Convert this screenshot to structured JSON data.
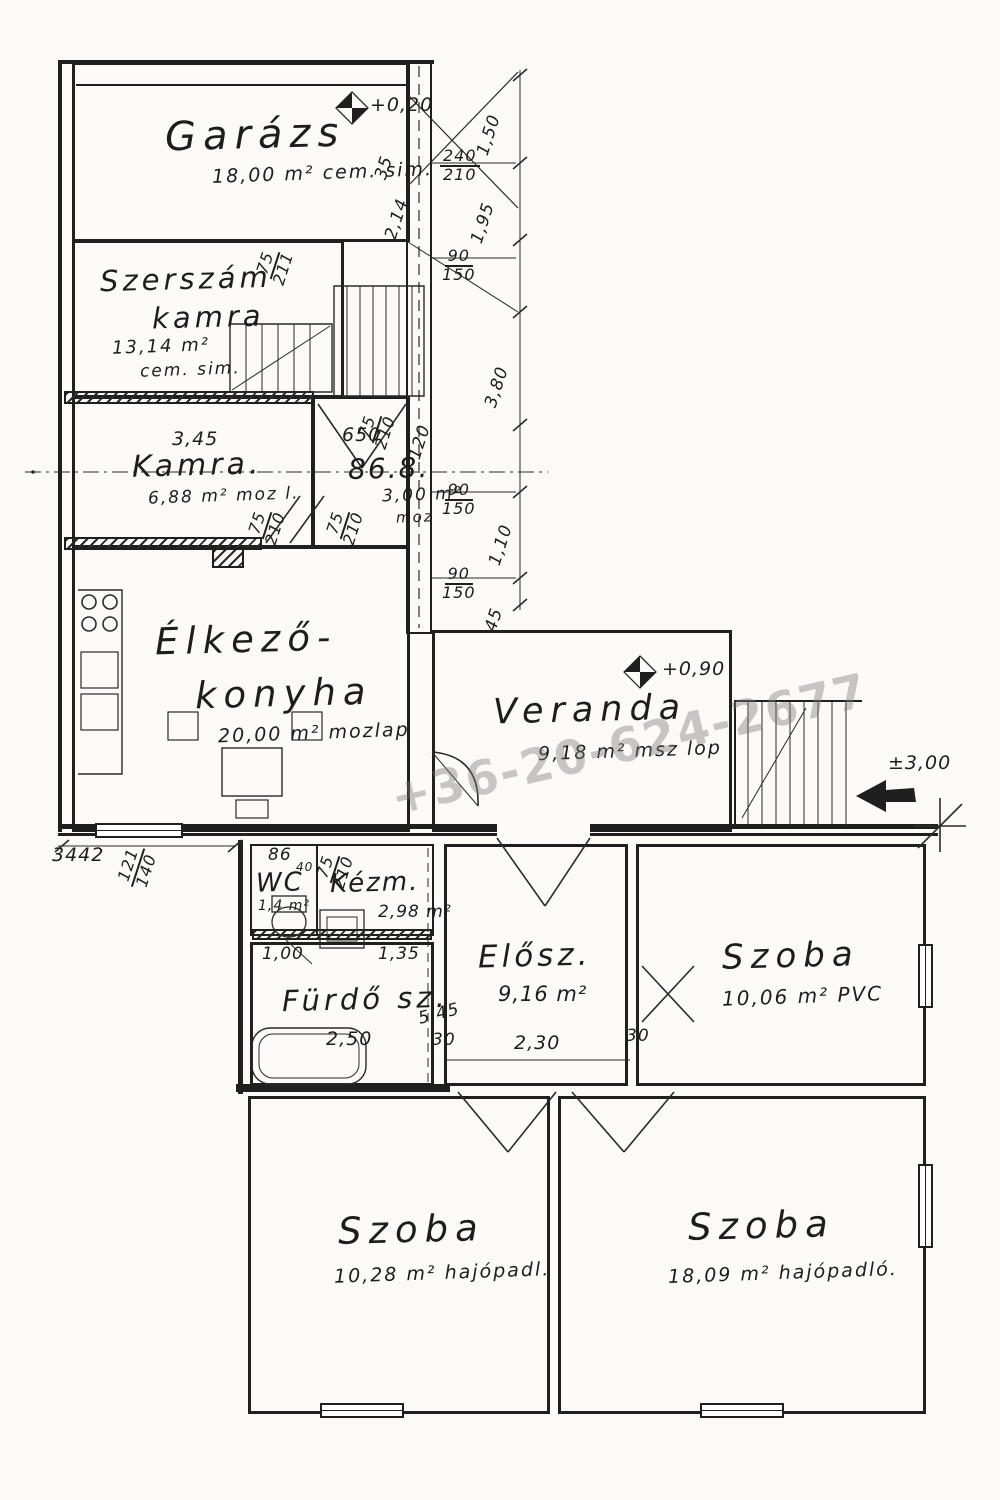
{
  "watermark": {
    "phone": "+36-20-624-2677"
  },
  "levels": {
    "garage": "+0,20",
    "veranda": "+0,90",
    "entry": "±3,00"
  },
  "rooms": [
    {
      "name": "Garázs",
      "area": "18,00 m²",
      "floor": "cem. sim."
    },
    {
      "name1": "Szerszám",
      "name2": "kamra",
      "area": "13,14 m²",
      "floor": "cem. sim."
    },
    {
      "name": "Kamra.",
      "area": "6,88 m²",
      "floor": "moz l."
    },
    {
      "name": "86.8.",
      "area": "3,00 m²",
      "floor": "moz"
    },
    {
      "name1": "Élkező-",
      "name2": "konyha",
      "area": "20,00 m²",
      "floor": "mozlap"
    },
    {
      "name": "Veranda",
      "area": "9,18 m²",
      "floor": "msz lop"
    },
    {
      "name": "WC",
      "area": "1,4 m²",
      "note": "40"
    },
    {
      "name": "Kézm.",
      "area": "2,98 m²"
    },
    {
      "name": "Fürdő sz.",
      "width": "2,50"
    },
    {
      "name": "Elősz.",
      "area": "9,16 m²",
      "width": "2,30"
    },
    {
      "name": "Szoba",
      "area": "10,06 m²",
      "floor": "PVC"
    },
    {
      "name": "Szoba",
      "area": "10,28 m²",
      "floor": "hajópadl."
    },
    {
      "name": "Szoba",
      "area": "18,09 m²",
      "floor": "hajópadló."
    }
  ],
  "dims": {
    "v150": "1,50",
    "v35": "35",
    "f240": "240",
    "f210": "210",
    "v195": "1,95",
    "v214": "2,14",
    "f75a": "75",
    "f211a": "211",
    "f90a": "90",
    "f150a": "150",
    "v380": "3,80",
    "h345": "3,45",
    "h650": "650",
    "f75b": "75",
    "f210b": "210",
    "v120": "120",
    "f90b": "90",
    "f150b": "150",
    "f75c": "75",
    "f210c": "210",
    "f75d": "75",
    "f210d": "210",
    "v110": "1,10",
    "f90c": "90",
    "f150c": "150",
    "v45": "45",
    "h3442": "3442",
    "f121": "121",
    "f140": "140",
    "n86": "86",
    "f75e": "75",
    "f210e": "210",
    "h100": "1,00",
    "h135": "1,35",
    "d545": "5,45",
    "w30a": "30",
    "h230": "2,30",
    "w30b": "30",
    "h250": "2,50"
  }
}
